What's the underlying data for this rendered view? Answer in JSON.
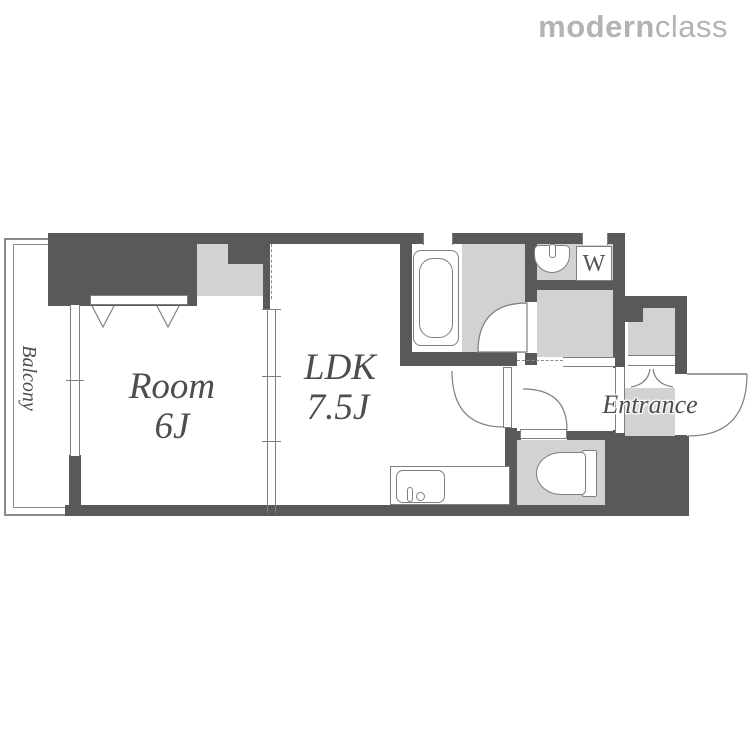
{
  "brand": {
    "part_bold": "modern",
    "part_light": "class"
  },
  "labels": {
    "balcony": "Balcony",
    "room_name": "Room",
    "room_size": "6J",
    "ldk_name": "LDK",
    "ldk_size": "7.5J",
    "entrance": "Entrance",
    "washer": "W"
  },
  "icons": {
    "bathtub": "bathtub-icon",
    "washbasin": "washbasin-icon",
    "washer_pan": "washing-machine-pan",
    "toilet": "toilet-icon",
    "kitchen_sink": "kitchen-sink-icon",
    "door_swing": "door-swing-arc",
    "folding_door": "folding-door-arc",
    "closet_fold_marks": "closet-door-v-marks"
  },
  "colors": {
    "wall": "#595959",
    "fill": "#d2d2d2",
    "line": "#7f7f7f",
    "label_text": "#4d4d4d",
    "logo": "#b3b3b3",
    "background": "#ffffff"
  }
}
